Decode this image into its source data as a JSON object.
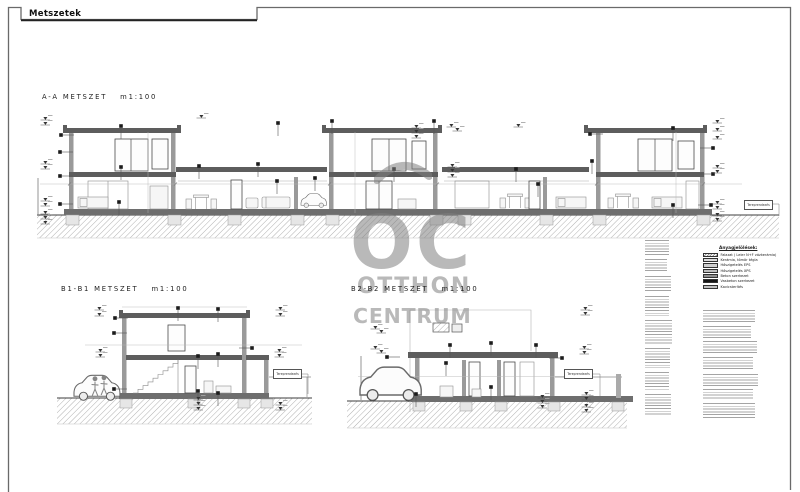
{
  "sheet": {
    "title": "Metszetek"
  },
  "sections": {
    "a": {
      "name": "A-A METSZET",
      "scale": "m1:100"
    },
    "b1": {
      "name": "B1-B1 METSZET",
      "scale": "m1:100"
    },
    "b2": {
      "name": "B2-B2 METSZET",
      "scale": "m1:100"
    }
  },
  "terrain_label": "Tereprendezés",
  "legend": {
    "title": "Anyagjelölések:",
    "items": [
      {
        "label": "Falazat ( Leier N+F vázkerámia)",
        "swatch": "diagonal-hatch"
      },
      {
        "label": "Kerámia, tömör tégla",
        "swatch": "#dcdcdc"
      },
      {
        "label": "Hőszigetelés EPS",
        "swatch": "#cfcfcf"
      },
      {
        "label": "Hőszigetelés XPS",
        "swatch": "#bdbdbd"
      },
      {
        "label": "Beton szerkezet",
        "swatch": "#8f8f8f"
      },
      {
        "label": "Vasbeton szerkezet",
        "swatch": "#161616"
      },
      {
        "label": "Kavicsterítés",
        "swatch": "speckle"
      }
    ]
  },
  "watermark": {
    "monogram": "OC",
    "line1": "OTTHON",
    "line2": "CENTRUM"
  }
}
